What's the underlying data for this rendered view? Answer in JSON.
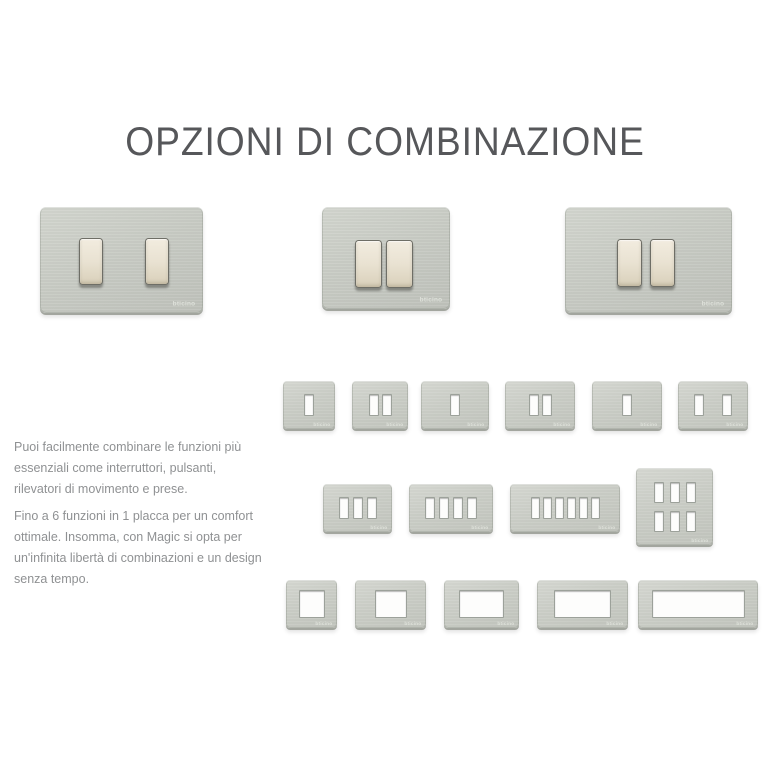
{
  "title": "OPZIONI DI COMBINAZIONE",
  "intro": {
    "p1": "Puoi facilmente combinare le funzioni più\nessenziali come interruttori, pulsanti,\nrilevatori di movimento e prese.",
    "p2": "Fino a 6 funzioni in 1 placca per un comfort\nottimale. Insomma, con Magic si opta per\nun'infinita libertà di combinazioni e un design\nsenza tempo."
  },
  "brand_mark": "bticino",
  "colors": {
    "background": "#ffffff",
    "title": "#56575a",
    "body_text": "#8f9193",
    "plate_metal": "#c9ccc5",
    "switch_cream": "#ebe5d6"
  },
  "plates": {
    "featured": [
      {
        "name": "plate-2-switches-spaced",
        "x": 40,
        "y": 207,
        "w": 163,
        "h": 106,
        "switch_w": 24,
        "switch_h": 47,
        "switches": [
          {
            "x": 39,
            "y": 31
          },
          {
            "x": 105,
            "y": 31
          }
        ]
      },
      {
        "name": "plate-2-switches-adjacent-compact",
        "x": 322,
        "y": 207,
        "w": 128,
        "h": 102,
        "switch_w": 27,
        "switch_h": 48,
        "switches": [
          {
            "x": 33,
            "y": 33
          },
          {
            "x": 64,
            "y": 33
          }
        ]
      },
      {
        "name": "plate-2-switches-adjacent-wide",
        "x": 565,
        "y": 207,
        "w": 167,
        "h": 106,
        "switch_w": 25,
        "switch_h": 48,
        "switches": [
          {
            "x": 52,
            "y": 32
          },
          {
            "x": 85,
            "y": 32
          }
        ]
      }
    ],
    "grid": [
      {
        "name": "plate-1-module-square",
        "x": 283,
        "y": 381,
        "w": 52,
        "h": 48,
        "win_h": 22,
        "gap": 3,
        "rows": [
          [
            10
          ]
        ]
      },
      {
        "name": "plate-2-module-square",
        "x": 352,
        "y": 381,
        "w": 56,
        "h": 48,
        "win_h": 22,
        "gap": 3,
        "rows": [
          [
            10,
            10
          ]
        ]
      },
      {
        "name": "plate-1-module-rect",
        "x": 421,
        "y": 381,
        "w": 68,
        "h": 48,
        "win_h": 22,
        "gap": 3,
        "rows": [
          [
            10
          ]
        ]
      },
      {
        "name": "plate-2-module-rect",
        "x": 505,
        "y": 381,
        "w": 70,
        "h": 48,
        "win_h": 22,
        "gap": 3,
        "rows": [
          [
            10,
            10
          ]
        ]
      },
      {
        "name": "plate-1-module-wide",
        "x": 592,
        "y": 381,
        "w": 70,
        "h": 48,
        "win_h": 22,
        "gap": 3,
        "rows": [
          [
            10
          ]
        ]
      },
      {
        "name": "plate-2-module-separated",
        "x": 678,
        "y": 381,
        "w": 70,
        "h": 48,
        "win_h": 22,
        "gap": 18,
        "rows": [
          [
            10,
            10
          ]
        ]
      },
      {
        "name": "plate-3-module",
        "x": 323,
        "y": 484,
        "w": 69,
        "h": 48,
        "win_h": 22,
        "gap": 4,
        "rows": [
          [
            10,
            10,
            10
          ]
        ]
      },
      {
        "name": "plate-4-module",
        "x": 409,
        "y": 484,
        "w": 84,
        "h": 48,
        "win_h": 22,
        "gap": 4,
        "rows": [
          [
            10,
            10,
            10,
            10
          ]
        ]
      },
      {
        "name": "plate-6-module-row",
        "x": 510,
        "y": 484,
        "w": 110,
        "h": 48,
        "win_h": 22,
        "gap": 3,
        "rows": [
          [
            9,
            9,
            9,
            9,
            9,
            9
          ]
        ]
      },
      {
        "name": "plate-6-module-grid",
        "x": 636,
        "y": 468,
        "w": 77,
        "h": 77,
        "win_h": 21,
        "gap": 6,
        "row_gap": 8,
        "rows": [
          [
            10,
            10,
            10
          ],
          [
            10,
            10,
            10
          ]
        ]
      },
      {
        "name": "plate-open-1",
        "x": 286,
        "y": 580,
        "w": 51,
        "h": 48,
        "win_h": 28,
        "gap": 0,
        "rows": [
          [
            26
          ]
        ]
      },
      {
        "name": "plate-open-2",
        "x": 355,
        "y": 580,
        "w": 71,
        "h": 48,
        "win_h": 28,
        "gap": 0,
        "rows": [
          [
            32
          ]
        ]
      },
      {
        "name": "plate-open-3",
        "x": 444,
        "y": 580,
        "w": 75,
        "h": 48,
        "win_h": 28,
        "gap": 0,
        "rows": [
          [
            45
          ]
        ]
      },
      {
        "name": "plate-open-4",
        "x": 537,
        "y": 580,
        "w": 91,
        "h": 48,
        "win_h": 28,
        "gap": 0,
        "rows": [
          [
            57
          ]
        ]
      },
      {
        "name": "plate-open-6",
        "x": 638,
        "y": 580,
        "w": 120,
        "h": 48,
        "win_h": 28,
        "gap": 0,
        "rows": [
          [
            93
          ]
        ]
      }
    ]
  }
}
